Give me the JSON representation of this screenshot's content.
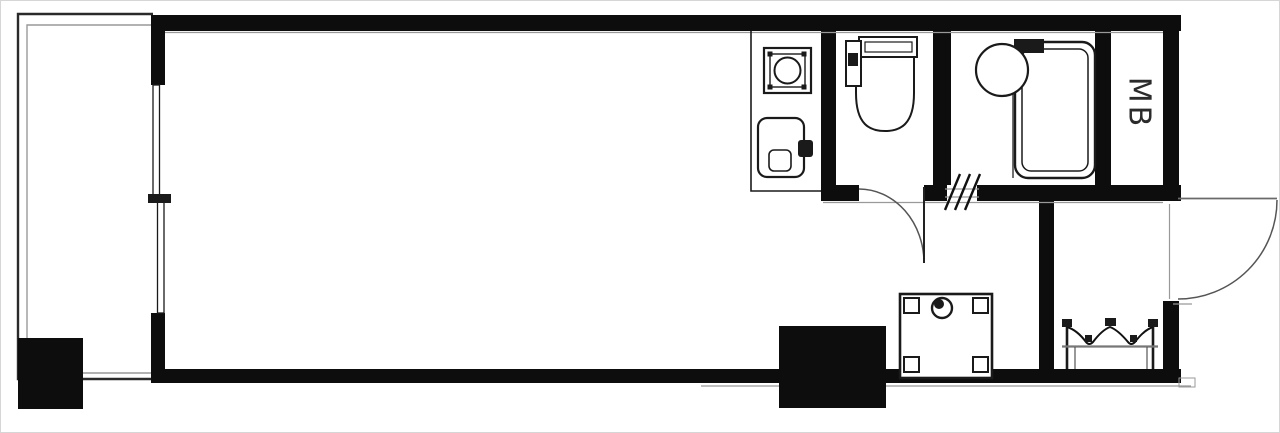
{
  "floorplan": {
    "meter_box_label": "MB",
    "colors": {
      "background": "#ffffff",
      "wall": "#0d0d0d",
      "fixture_line": "#1a1a1a",
      "thin_line": "#555555",
      "accent_gray": "#999999",
      "border": "#d6d6d6"
    }
  }
}
